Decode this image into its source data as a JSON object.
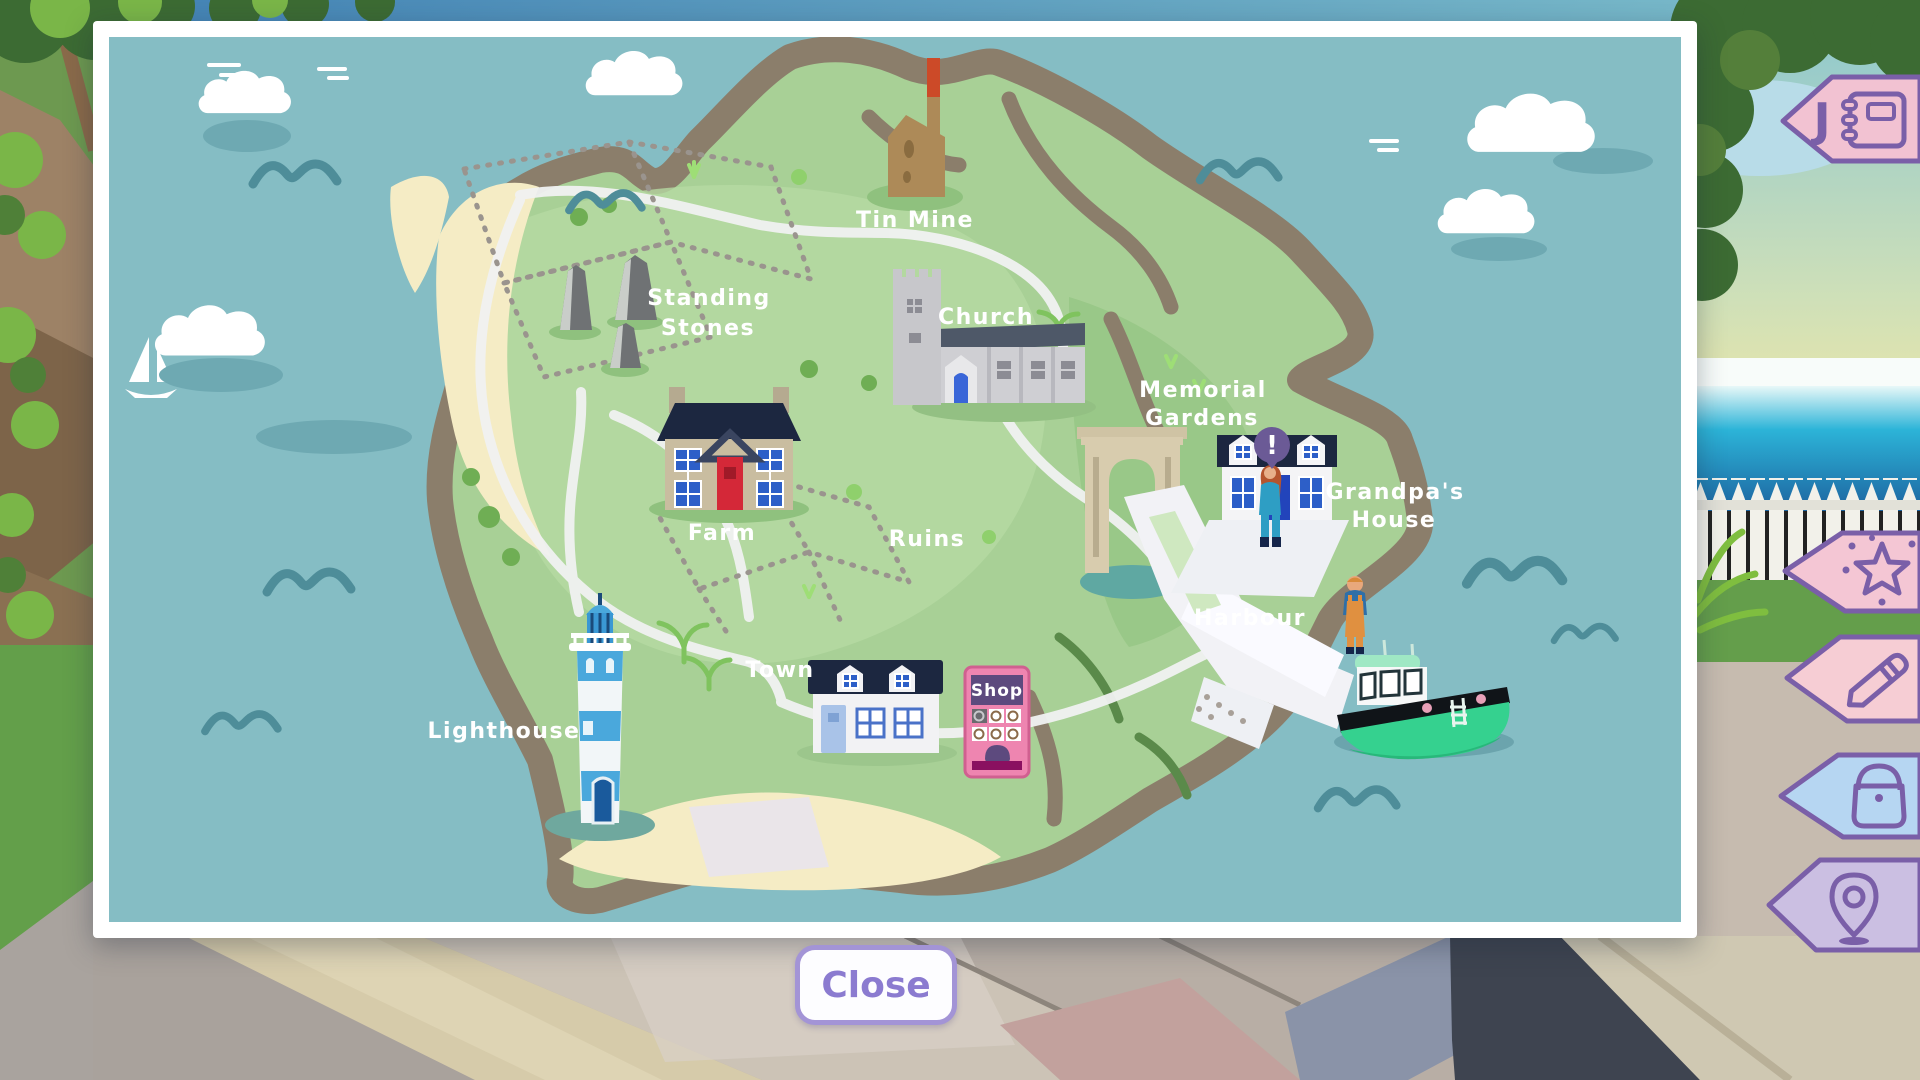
{
  "map": {
    "labels": {
      "tin_mine": "Tin Mine",
      "standing_stones_line1": "Standing",
      "standing_stones_line2": "Stones",
      "church": "Church",
      "memorial_gardens_line1": "Memorial",
      "memorial_gardens_line2": "Gardens",
      "grandpas_house_line1": "Grandpa's",
      "grandpas_house_line2": "House",
      "farm": "Farm",
      "ruins": "Ruins",
      "harbour": "Harbour",
      "town": "Town",
      "shop": "Shop",
      "lighthouse": "Lighthouse"
    },
    "marker": {
      "exclamation": "!"
    }
  },
  "sidebar": {
    "journal": {
      "letter": "J",
      "icon": "journal-icon",
      "color": "#f2c2d2"
    },
    "tags": [
      {
        "icon": "star-icon",
        "color": "#f4c6d4"
      },
      {
        "icon": "pencil-icon",
        "color": "#f6cdd4"
      },
      {
        "icon": "bag-icon",
        "color": "#b6d6f2"
      },
      {
        "icon": "map-pin-icon",
        "color": "#cbbfe2"
      }
    ]
  },
  "close_button": {
    "label": "Close"
  },
  "colors": {
    "map_ocean": "#85bdc4",
    "island_green": "#a8d096",
    "coast_brown": "#8b7e6b",
    "sand": "#f5ecc5",
    "tag_outline_purple": "#7a5fa8",
    "close_purple": "#8b7bd0",
    "marker_purple": "#6b5a96",
    "boat_green": "#35d18f",
    "roof_navy": "#1c2740",
    "shop_pink": "#ee85b0"
  }
}
